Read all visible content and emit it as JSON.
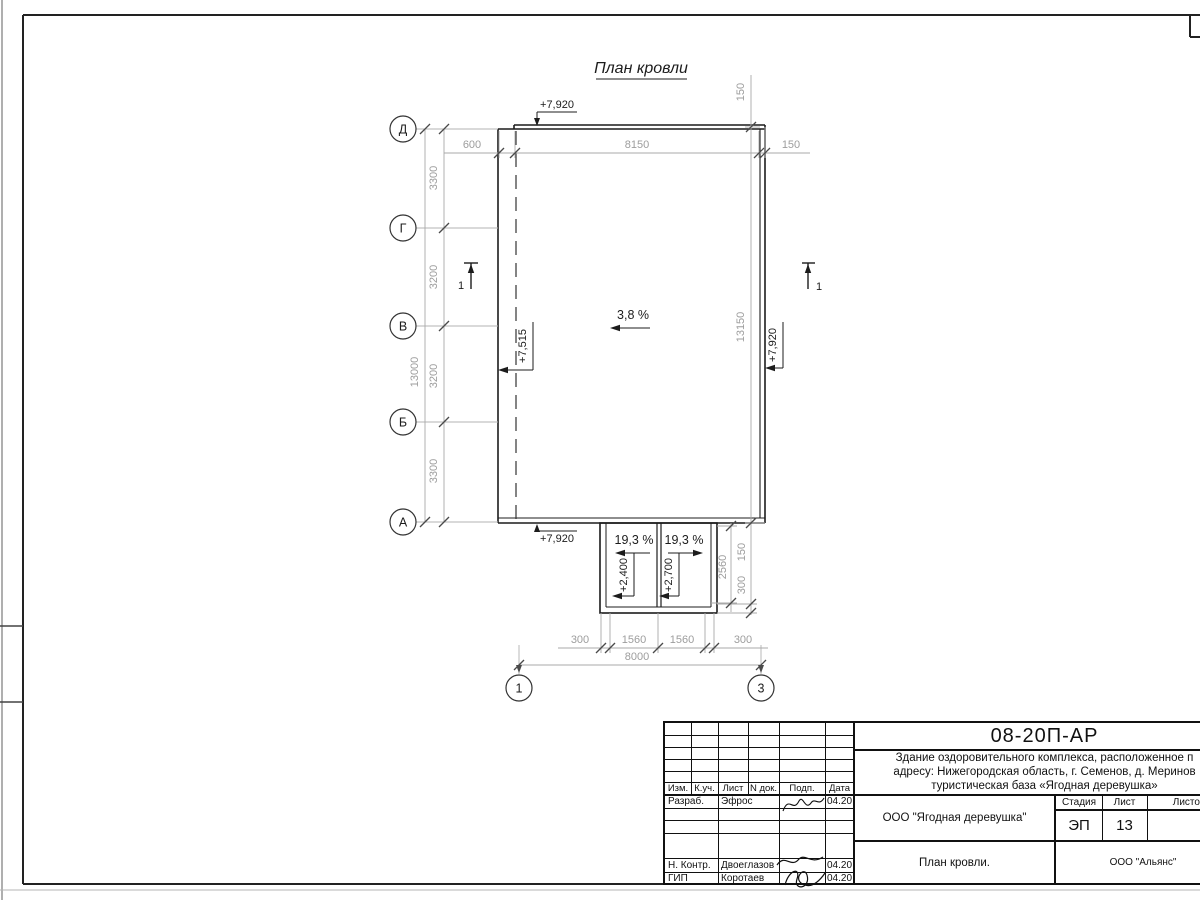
{
  "plan": {
    "title": "План кровли",
    "slopes": {
      "main": "3,8 %",
      "canopy_left": "19,3 %",
      "canopy_right": "19,3 %"
    },
    "elevations": {
      "top": "+7,920",
      "bottom": "+7,920",
      "right": "+7,920",
      "left": "+7,515",
      "canopy_left": "+2,400",
      "canopy_right": "+2,700"
    },
    "axes": {
      "rows": [
        "Д",
        "Г",
        "В",
        "Б",
        "А"
      ],
      "cols": [
        "1",
        "3"
      ]
    },
    "section_label": "1",
    "dims": {
      "top": [
        "600",
        "8150",
        "150"
      ],
      "left": [
        "3300",
        "3200",
        "3200",
        "3300"
      ],
      "left_total": "13000",
      "right_parapet": "150",
      "right_total": "13150",
      "canopy_depth": "2560",
      "canopy_side": [
        "150",
        "300"
      ],
      "bottom": [
        "300",
        "1560",
        "1560",
        "300"
      ],
      "bottom_total": "8000"
    }
  },
  "stamp": {
    "doc_code": "08-20П-АР",
    "project_line1": "Здание оздоровительного комплекса, расположенное п",
    "project_line2": "адресу: Нижегородская область, г. Семенов, д. Меринов",
    "project_line3": "туристическая база «Ягодная деревушка»",
    "header_cells": [
      "Изм.",
      "К.уч.",
      "Лист",
      "N док.",
      "Подп.",
      "Дата"
    ],
    "rows": [
      {
        "role": "Разраб.",
        "name": "Эфрос",
        "date": "04.20"
      },
      {
        "role": "Н. Контр.",
        "name": "Двоеглазов",
        "date": "04.20"
      },
      {
        "role": "ГИП",
        "name": "Коротаев",
        "date": "04.20"
      }
    ],
    "org_object": "ООО \"Ягодная деревушка\"",
    "sheet_title": "План кровли.",
    "org": "ООО \"Альянс\"",
    "stadia_label": "Стадия",
    "stadia_value": "ЭП",
    "list_label": "Лист",
    "list_value": "13",
    "listov_label": "Листов"
  }
}
